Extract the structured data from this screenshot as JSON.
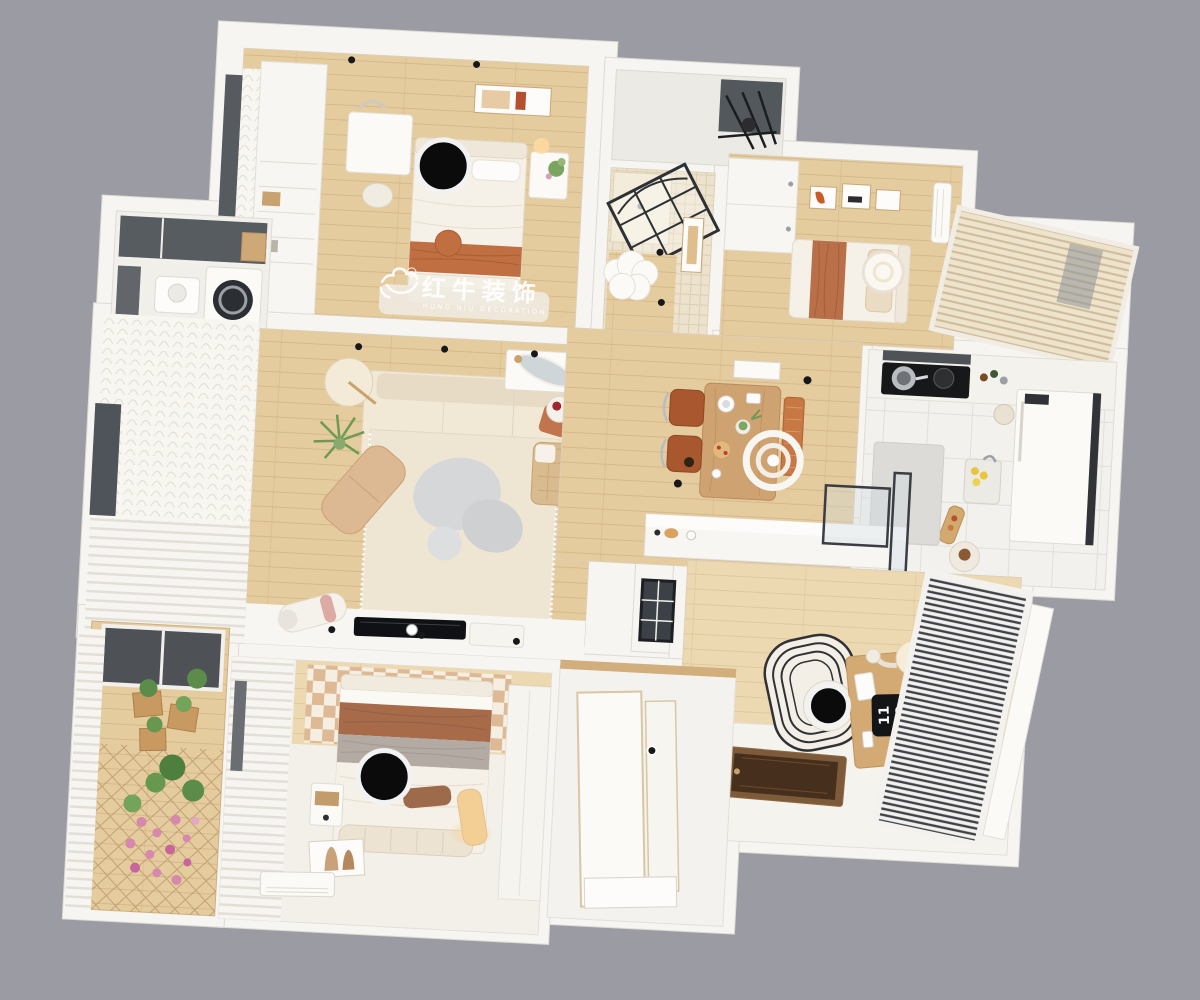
{
  "scene": {
    "render_type": "top-down 3D apartment floor plan render",
    "background_color": "#9b9ba3"
  },
  "watermark": {
    "title": "红牛装饰",
    "subtitle": "HONG NIU DECORATION",
    "registered_mark": "®",
    "text_color": "#ffffff",
    "logo_icon": "bull-icon"
  },
  "study_desk": {
    "flip_clock_top": "11",
    "flip_clock_bottom": "12"
  },
  "privacy_masks": {
    "count": 3,
    "color": "#0b0b0b",
    "ring_color": "#f2f2f2"
  },
  "palette": {
    "wall": "#f7f5f2",
    "wall_edge": "#dedad3",
    "wood_floor": "#e4cc9f",
    "wood_dark": "#d3b384",
    "tile": "#f3f1ed",
    "terracotta": "#bf7450",
    "cream_sofa": "#f2e8d6",
    "leather_chair": "#a8572e",
    "table_wood": "#cfa271",
    "glass_dark": "#53585d",
    "plant_green": "#6d9a55",
    "flower_pink": "#d887ad",
    "rug_gray": "#d6d7d8"
  },
  "rooms": [
    {
      "id": "bedroom-1",
      "contents": [
        "bed",
        "wardrobe",
        "vanity-desk",
        "nightstand",
        "picture-frame",
        "privacy-mask"
      ]
    },
    {
      "id": "laundry-balcony",
      "contents": [
        "washing-machine",
        "sink",
        "window"
      ]
    },
    {
      "id": "living-room",
      "contents": [
        "sofa",
        "rug",
        "blob-coffee-tables",
        "chaise",
        "floor-lamp",
        "plant",
        "console-mirror",
        "tv",
        "speaker"
      ]
    },
    {
      "id": "bathroom",
      "contents": [
        "shower-glass-door",
        "tile-floor",
        "cloud-rug"
      ]
    },
    {
      "id": "drying-balcony",
      "contents": [
        "drying-racks"
      ]
    },
    {
      "id": "bedroom-2",
      "contents": [
        "single-bed",
        "wardrobe",
        "picture-frames",
        "ceiling-lamp",
        "ac-unit",
        "blinds-window"
      ]
    },
    {
      "id": "dining",
      "contents": [
        "wood-table",
        "leather-chairs",
        "rattan-bench",
        "ring-pendant"
      ]
    },
    {
      "id": "kitchen",
      "contents": [
        "stove",
        "pots",
        "fridge",
        "sink-lemons",
        "gray-rug"
      ]
    },
    {
      "id": "stairwell",
      "contents": [
        "half-wall",
        "glass-railing",
        "wood-steps"
      ]
    },
    {
      "id": "study",
      "contents": [
        "desk",
        "flip-clock",
        "desk-lamp",
        "chair",
        "striped-rug",
        "venetian-blinds",
        "entry-door",
        "privacy-mask"
      ]
    },
    {
      "id": "master-bedroom",
      "contents": [
        "bed",
        "checker-rug",
        "bench",
        "nightstand",
        "glow-lamp",
        "art-print",
        "ac-unit",
        "curtains",
        "privacy-mask"
      ]
    },
    {
      "id": "flower-balcony",
      "contents": [
        "flowers",
        "planters",
        "lattice-floor",
        "shutters"
      ]
    },
    {
      "id": "entry-corridor",
      "contents": [
        "white-floor",
        "wood-trim"
      ]
    }
  ]
}
